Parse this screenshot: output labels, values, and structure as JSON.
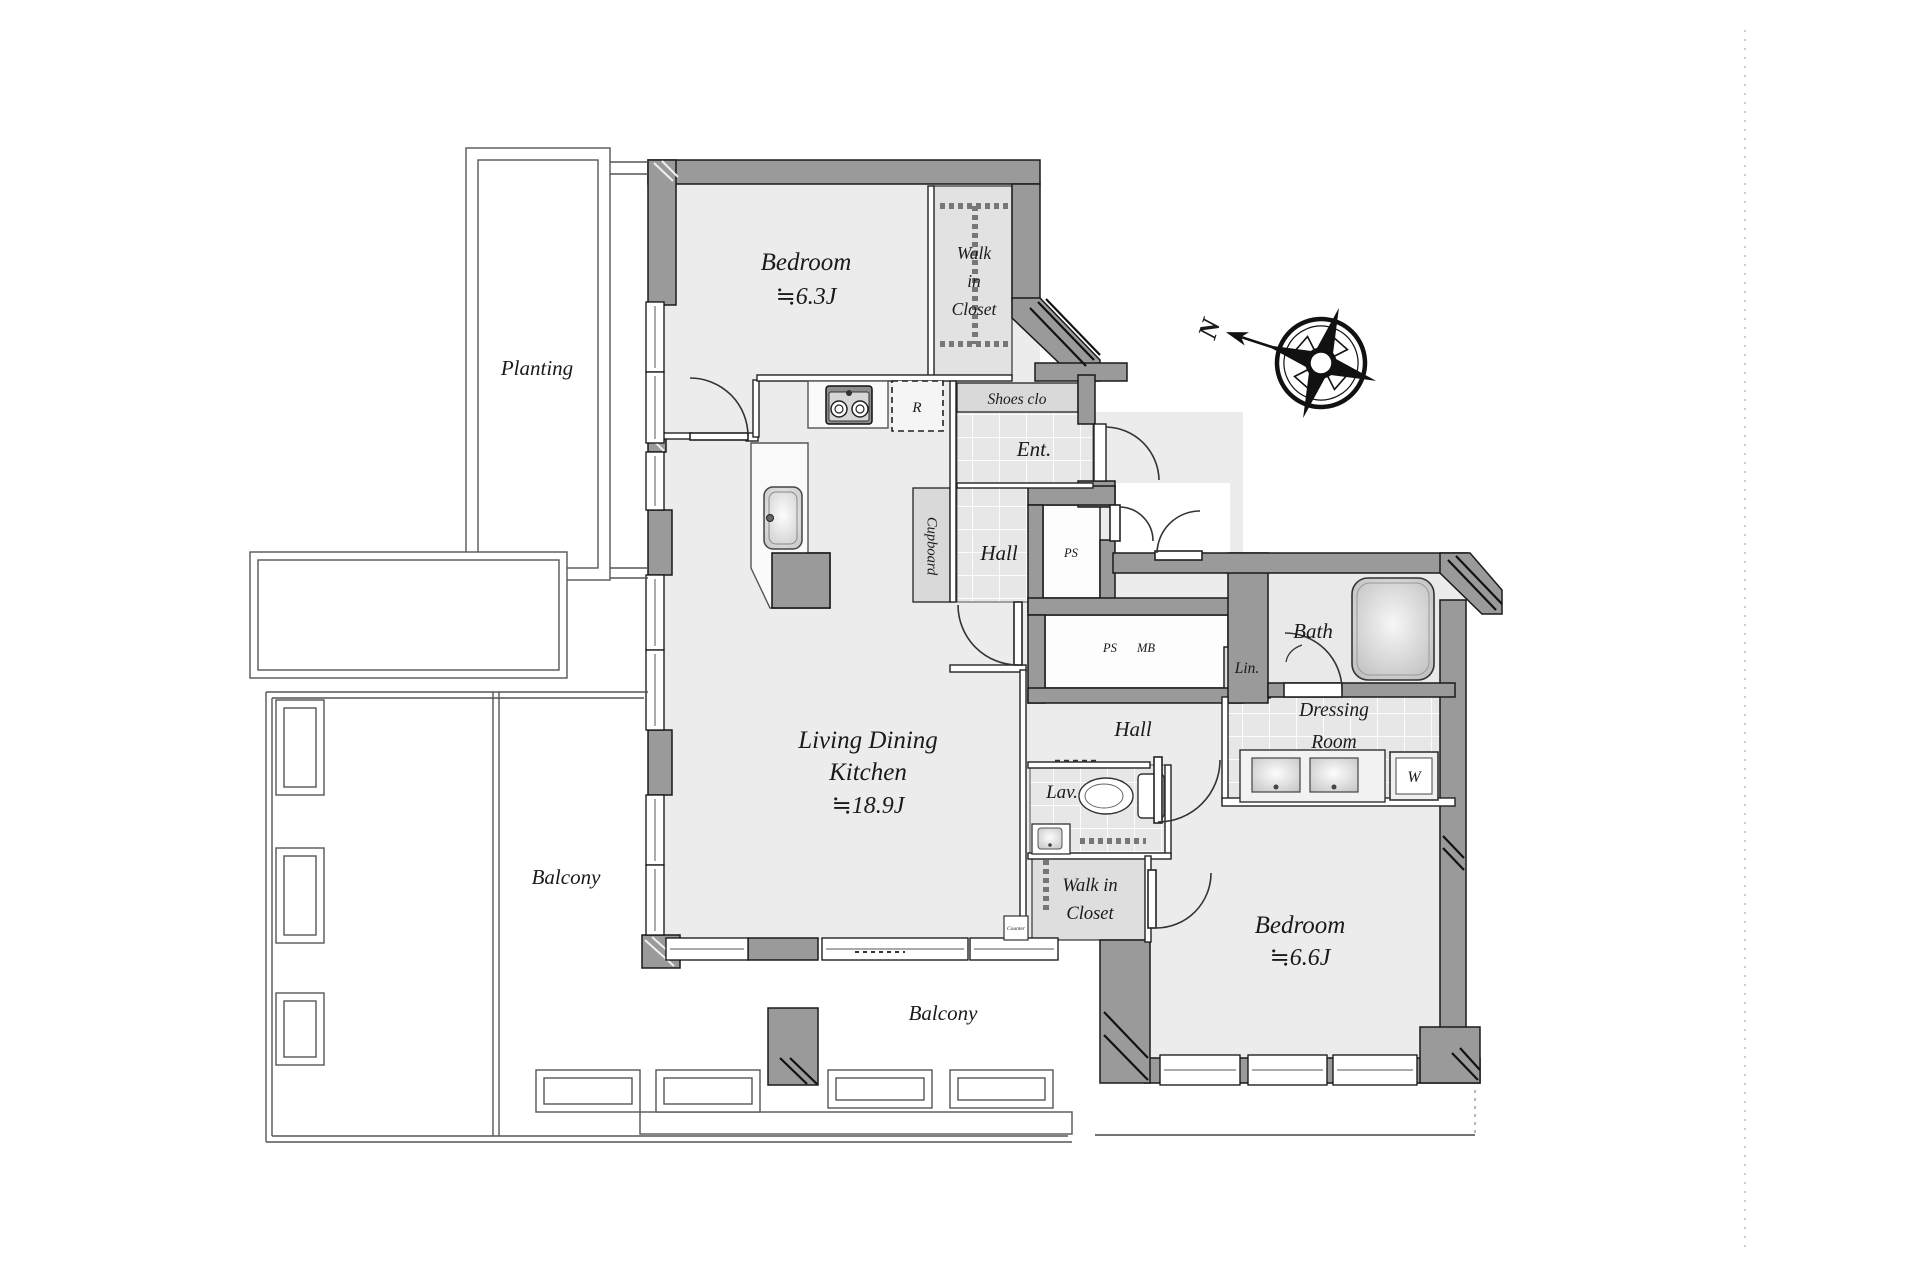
{
  "page": {
    "background": "#ffffff"
  },
  "compass": {
    "north_label": "N"
  },
  "outdoor": {
    "planting": {
      "label": "Planting"
    },
    "balcony_left": {
      "label": "Balcony"
    },
    "balcony_bottom": {
      "label": "Balcony"
    }
  },
  "rooms": {
    "bedroom1": {
      "label": "Bedroom",
      "size": "≒6.3J"
    },
    "walk_in_closet1": {
      "line1": "Walk",
      "line2": "in",
      "line3": "Closet"
    },
    "shoes_closet": {
      "label": "Shoes clo"
    },
    "entrance": {
      "label": "Ent."
    },
    "hall1": {
      "label": "Hall"
    },
    "pipe_space_upper": {
      "label": "PS"
    },
    "pipe_space": {
      "label": "PS"
    },
    "meter_box": {
      "label": "MB"
    },
    "living_dining_kitchen": {
      "line1": "Living Dining",
      "line2": "Kitchen",
      "size": "≒18.9J"
    },
    "hall2": {
      "label": "Hall"
    },
    "lavatory": {
      "label": "Lav."
    },
    "walk_in_closet2": {
      "line1": "Walk in",
      "line2": "Closet"
    },
    "bath": {
      "label": "Bath"
    },
    "linen": {
      "label": "Lin."
    },
    "dressing_room": {
      "line1": "Dressing",
      "line2": "Room"
    },
    "bedroom2": {
      "label": "Bedroom",
      "size": "≒6.6J"
    }
  },
  "fixtures": {
    "refrigerator": {
      "label": "R"
    },
    "cupboard": {
      "label": "Cupboard"
    },
    "washing_machine": {
      "label": "W"
    },
    "counter": {
      "label": "Counter"
    }
  },
  "colors": {
    "wall": "#9a9a9a",
    "room": "#ececec",
    "tile": "#e7e7e7",
    "line": "#1a1a1a"
  }
}
